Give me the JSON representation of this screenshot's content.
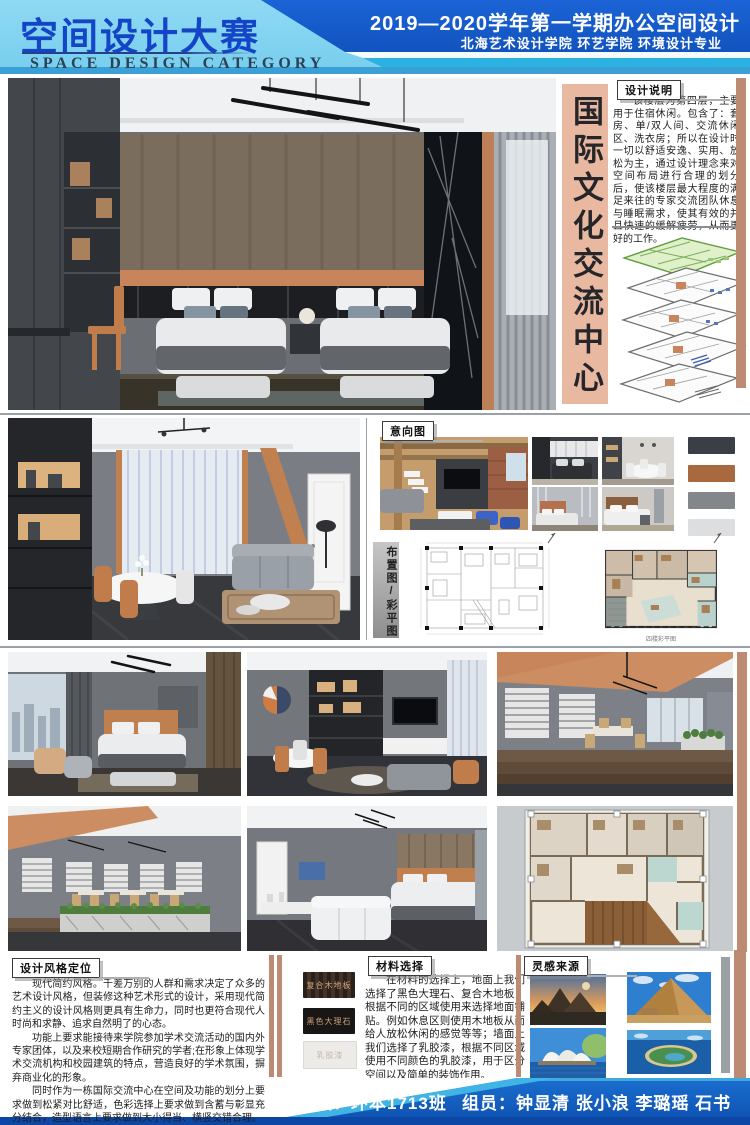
{
  "header": {
    "title": "空间设计大赛",
    "subtitle": "SPACE DESIGN CATEGORY",
    "session": "2019—2020学年第一学期办公空间设计",
    "school": "北海艺术设计学院 环艺学院 环境设计专业"
  },
  "center_title": {
    "text": "国际文化交流中心",
    "bg": "#e8b9a0"
  },
  "design_notes": {
    "label": "设计说明",
    "body": "该楼层为第四层，主要用于住宿休闲。包含了：套房、单/双人间、交流休闲区、洗衣房；所以在设计时一切以舒适安逸、实用、放松为主，通过设计理念来对空间布局进行合理的划分后，使该楼层最大程度的满足来往的专家交流团队休息与睡眠需求，使其有效的并且快速的缓解疲劳，从而更好的工作。"
  },
  "moodboard": {
    "label": "意向图",
    "palette": [
      "#3a3e45",
      "#a8693f",
      "#83868a",
      "#dcdee0"
    ]
  },
  "plans": {
    "label": "布置图/彩平图",
    "caption": "四楼彩平图"
  },
  "style_positioning": {
    "label": "设计风格定位",
    "paragraphs": [
      "现代简约风格。千差万别的人群和需求决定了众多的艺术设计风格，但装修这种艺术形式的设计，采用现代简约主义的设计风格则更具有生命力，同时也更符合现代人时尚和求静、追求自然明了的心态。",
      "功能上要求能接待来学院参加学术交流活动的国内外专家团体，以及来校短期合作研究的学者;在形象上体现学术交流机构和校园建筑的特点，营造良好的学术氛围，摒弃商业化的形象。",
      "同时作为一栋国际交流中心在空间及功能的划分上要求做到松紧对比舒适，色彩选择上要求做到含蓄与彰显充分结合，造型语言上要求做到大小得当、横竖交错合理。"
    ]
  },
  "materials": {
    "label": "材料选择",
    "swatches": [
      {
        "name": "复合木地板",
        "bg": "#3a2c21",
        "fg": "#d3a67b"
      },
      {
        "name": "黑色大理石",
        "bg": "#191715",
        "fg": "#cfa277"
      },
      {
        "name": "乳胶漆",
        "bg": "#edebe7",
        "fg": "#c8b6a4"
      }
    ],
    "body": "在材料的选择上，地面上我们选择了黑色大理石、复合木地板，根据不同的区域使用来选择地面铺贴。例如休息区则使用木地板从而给人放松休闲的感觉等等；墙面上我们选择了乳胶漆，根据不同区域使用不同颜色的乳胶漆，用于区分空间以及简单的装饰作用。"
  },
  "inspiration": {
    "label": "灵感来源"
  },
  "footer": {
    "class_info": "班级：环本1713班",
    "members": "组员：钟显清 张小浪 李璐瑶 石书"
  },
  "accents": {
    "salmon": "#bd8a74",
    "header_blue": "#1b63d6",
    "header_light": "#79cfee"
  },
  "icons": {
    "north_arrow": "↗"
  }
}
